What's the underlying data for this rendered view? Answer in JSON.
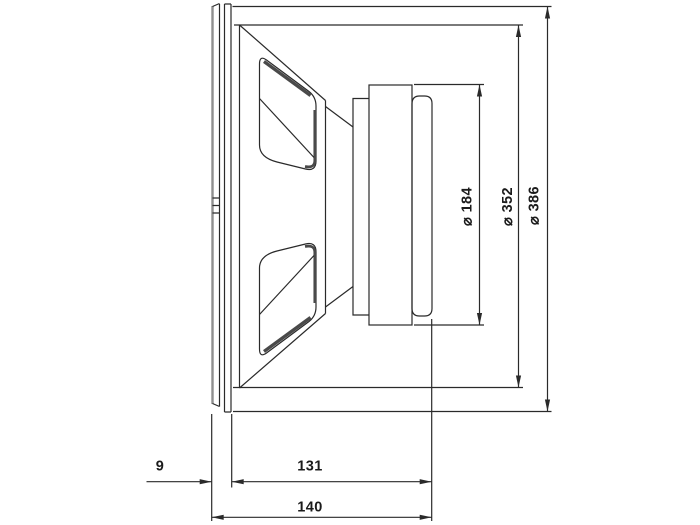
{
  "page": {
    "background": "#ffffff"
  },
  "drawing": {
    "type": "technical_dimension_drawing",
    "subject": "loudspeaker-side-view",
    "colors": {
      "line": "#2a2a2a",
      "shade": "#4a4a4a",
      "gasket_edge": "#8f8f8f",
      "text": "#1b1b1b",
      "background": "#ffffff"
    },
    "dimensions": {
      "diameters": [
        {
          "label": "⌀ 184"
        },
        {
          "label": "⌀ 352"
        },
        {
          "label": "⌀ 386"
        }
      ],
      "widths": [
        {
          "label": "9"
        },
        {
          "label": "131"
        },
        {
          "label": "140"
        }
      ]
    }
  }
}
